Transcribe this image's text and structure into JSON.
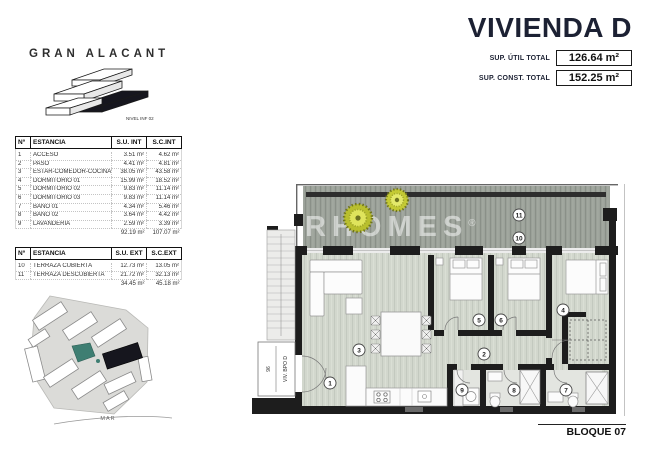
{
  "header": {
    "brand": "GRAN ALACANT",
    "brand_level_label": "NIVEL INF 02",
    "title": "VIVIENDA D",
    "totals": [
      {
        "label": "SUP. ÚTIL TOTAL",
        "value": "126.64 m²"
      },
      {
        "label": "SUP. CONST. TOTAL",
        "value": "152.25 m²"
      }
    ]
  },
  "tables": {
    "interior": {
      "headers": [
        "Nº",
        "ESTANCIA",
        "S.U. INT",
        "S.C.INT"
      ],
      "rows": [
        [
          "1",
          "ACCESO",
          "3.51 m²",
          "4.62 m²"
        ],
        [
          "2",
          "PASO",
          "4.41 m²",
          "4.81 m²"
        ],
        [
          "3",
          "ESTAR-COMEDOR-COCINA",
          "38.05 m²",
          "43.58 m²"
        ],
        [
          "4",
          "DORMITORIO 01",
          "15.99 m²",
          "18.52 m²"
        ],
        [
          "5",
          "DORMITORIO 02",
          "9.83 m²",
          "11.14 m²"
        ],
        [
          "6",
          "DORMITORIO 03",
          "9.83 m²",
          "11.14 m²"
        ],
        [
          "7",
          "BAÑO 01",
          "4.34 m²",
          "5.46 m²"
        ],
        [
          "8",
          "BAÑO 02",
          "3.64 m²",
          "4.42 m²"
        ],
        [
          "9",
          "LAVANDERIA",
          "2.59 m²",
          "3.39 m²"
        ]
      ],
      "totals": [
        "92.19 m²",
        "107.07 m²"
      ]
    },
    "exterior": {
      "headers": [
        "Nº",
        "ESTANCIA",
        "S.U. EXT",
        "S.C.EXT"
      ],
      "rows": [
        [
          "10",
          "TERRAZA CUBIERTA",
          "12.73 m²",
          "13.05 m²"
        ],
        [
          "11",
          "TERRAZA DESCUBIERTA",
          "21.72 m²",
          "32.13 m²"
        ]
      ],
      "totals": [
        "34.45 m²",
        "45.18 m²"
      ]
    }
  },
  "site_plan": {
    "sea_label": "MAR"
  },
  "floor_plan": {
    "watermark": "AIRHOMES",
    "watermark_reg": "®",
    "unit_label": "VIV. BPO D",
    "unit_number": "96",
    "block_label": "BLOQUE 07",
    "markers": {
      "m1": "1",
      "m2": "2",
      "m3": "3",
      "m4": "4",
      "m5": "5",
      "m6": "6",
      "m7": "7",
      "m8": "8",
      "m9": "9",
      "m10": "10",
      "m11": "11"
    }
  },
  "colors": {
    "accent_navy": "#1c2133",
    "wall_black": "#1d1d1d",
    "deck_gray": "#9ca29a",
    "floor_sage": "#d2d7cd",
    "plant_yellow": "#cdd335",
    "pool_teal": "#3e7e72",
    "highlight_building": "#16161e"
  }
}
